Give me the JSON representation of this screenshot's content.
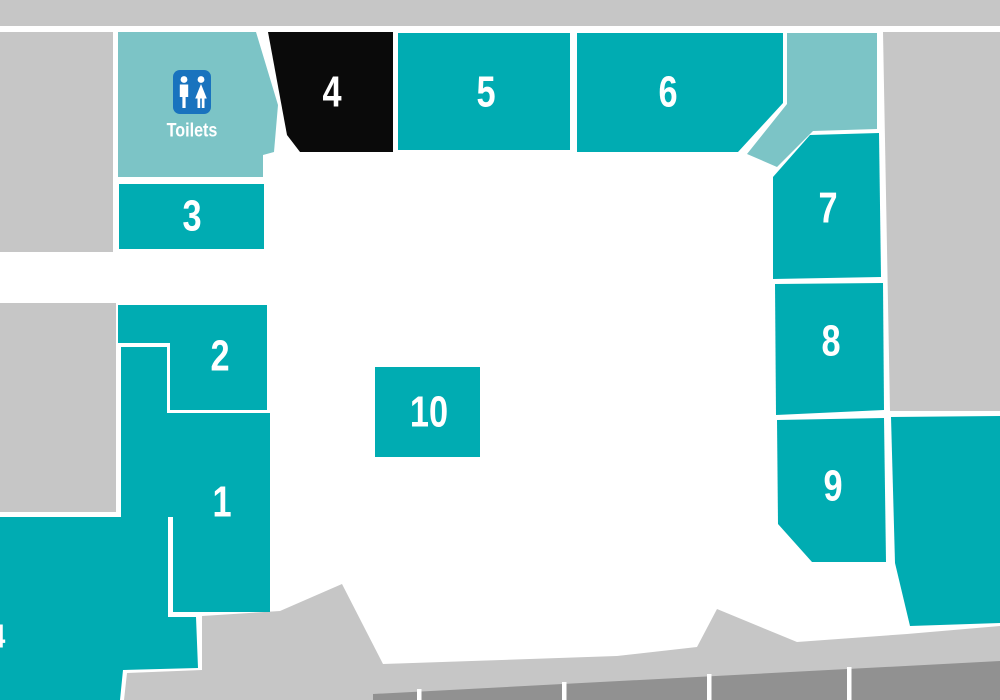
{
  "map": {
    "title": "venue-floor-plan",
    "toilets": {
      "label": "Toilets"
    },
    "units": [
      {
        "id": "1",
        "label": "1"
      },
      {
        "id": "2",
        "label": "2"
      },
      {
        "id": "3",
        "label": "3"
      },
      {
        "id": "4",
        "label": "4",
        "state": "highlighted-black"
      },
      {
        "id": "5",
        "label": "5"
      },
      {
        "id": "6",
        "label": "6"
      },
      {
        "id": "7",
        "label": "7"
      },
      {
        "id": "8",
        "label": "8"
      },
      {
        "id": "9",
        "label": "9"
      },
      {
        "id": "10",
        "label": "10"
      },
      {
        "id": "partial-4",
        "label": "4",
        "note": "partially visible at left edge"
      }
    ]
  },
  "colors": {
    "teal": "#00ACB2",
    "teal_light": "#7CC4C6",
    "highlight_black": "#0A0A0A",
    "gray": "#C6C6C6",
    "gray_dark": "#919191",
    "white": "#FFFFFF",
    "toilet_blue": "#1973BE"
  }
}
